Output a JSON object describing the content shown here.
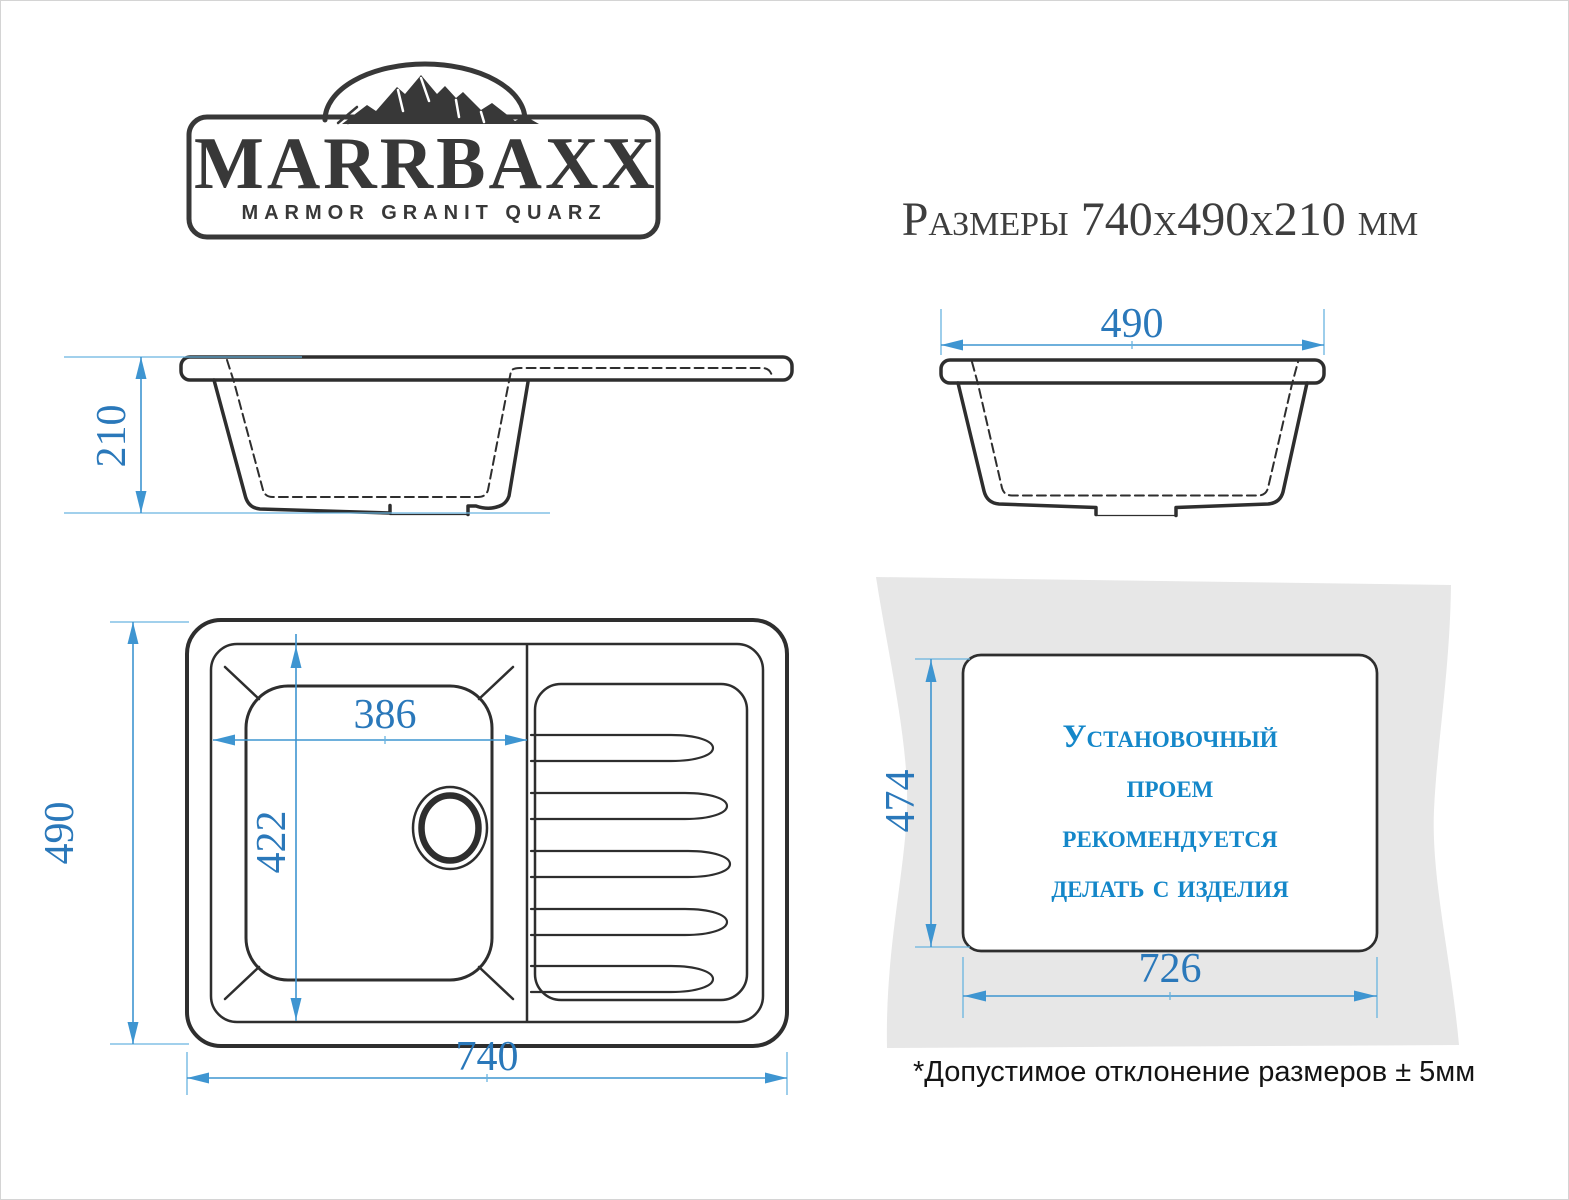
{
  "logo": {
    "brand": "MARRBAXX",
    "tagline": "MARMOR GRANIT QUARZ"
  },
  "title": "Размеры 740х490х210 мм",
  "views": {
    "side_section": {
      "depth_mm": "210"
    },
    "front_section": {
      "width_mm": "490"
    },
    "top": {
      "length_mm": "740",
      "width_mm": "490",
      "bowl_length_mm": "386",
      "bowl_width_mm": "422"
    },
    "install_cutout": {
      "length_mm": "726",
      "width_mm": "474",
      "note_lines": [
        "Установочный",
        "проем",
        "рекомендуется",
        "делать с изделия"
      ]
    }
  },
  "footnote": "*Допустимое отклонение размеров  ± 5мм",
  "colors": {
    "line": "#2e2e2e",
    "logo": "#383838",
    "title_text": "#3e3e3e",
    "note_text": "#141414",
    "dimension": "#3e95d1",
    "dimension_ext": "#69b4e0",
    "dimension_text": "#2a78ba",
    "cutout_text": "#1487c9",
    "countertop_fill": "#e7e7e7"
  }
}
